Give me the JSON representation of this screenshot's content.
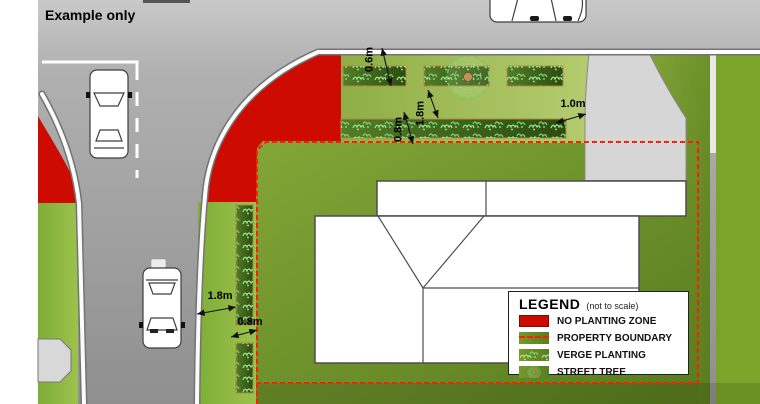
{
  "header": {
    "title": "Example only"
  },
  "legend": {
    "title": "LEGEND",
    "subtitle": "(not to scale)",
    "items": [
      {
        "key": "no-planting-zone",
        "label": "NO PLANTING ZONE"
      },
      {
        "key": "property-boundary",
        "label": "PROPERTY BOUNDARY"
      },
      {
        "key": "verge-planting",
        "label": "VERGE PLANTING"
      },
      {
        "key": "street-tree",
        "label": "STREET TREE"
      }
    ]
  },
  "dimensions": {
    "top_strip_depth": "0.6m",
    "top_strip_gap": "1.8m",
    "lower_strip_depth": "0.8m",
    "driveway_clearance": "1.0m",
    "west_verge_width": "1.8m",
    "west_strip_width": "0.8m"
  },
  "colors": {
    "no_planting_red": "#ce0b00",
    "boundary_red": "#ff1e00",
    "verge_green": "#9dbb55",
    "lot_green": "#6f9226",
    "strip_green": "#3f661c",
    "road_gray": "#a8a8a8",
    "driveway_gray": "#d6d6d6",
    "tree_trunk": "#c49057"
  }
}
